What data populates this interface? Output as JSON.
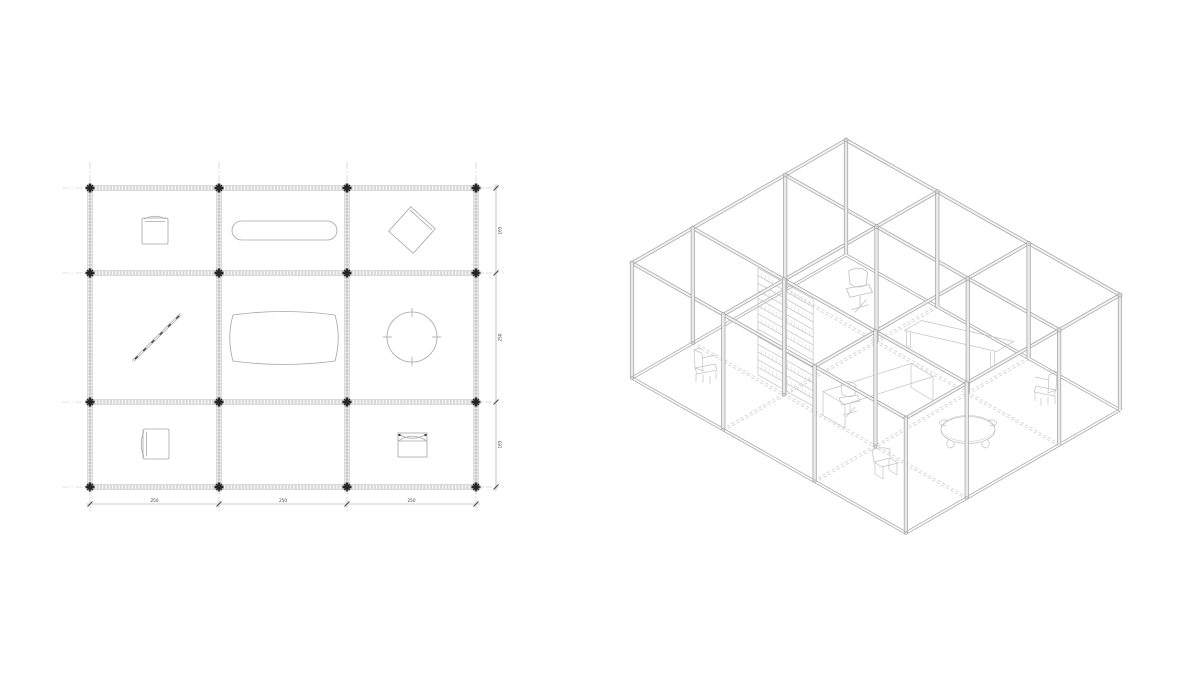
{
  "sheet": {
    "width": 1200,
    "height": 675,
    "background": "#ffffff"
  },
  "plan": {
    "title": "floor-plan",
    "grid_x": [
      90,
      219,
      347,
      476
    ],
    "grid_y": [
      188,
      273,
      402,
      487
    ],
    "centerline_extension": 26,
    "styles": {
      "wall_fill": "#d8d8d8",
      "wall_edge": "#b3b3b3",
      "centerline": "#c4c4c4",
      "column_marker": "#262626",
      "furniture_line": "#a6a6a6",
      "dim_line": "#9a9a9a",
      "tick": "#4a4a4a",
      "text": "#3f3f3f"
    },
    "dimensions_bottom": {
      "y": 504,
      "labels": [
        "250",
        "250",
        "250"
      ]
    },
    "dimensions_right": {
      "x": 496,
      "labels": [
        "165",
        "250",
        "165"
      ]
    },
    "furniture": [
      {
        "type": "chair",
        "name": "armchair-top-left",
        "x": 142,
        "y": 218,
        "w": 26,
        "h": 26,
        "back": "top"
      },
      {
        "type": "stadium",
        "name": "shelf-top-middle",
        "x": 232,
        "y": 221,
        "w": 105,
        "h": 19
      },
      {
        "type": "diamond",
        "name": "armchair-rotated-top-right",
        "cx": 412,
        "cy": 230,
        "s": 33,
        "rot": 42
      },
      {
        "type": "ladder",
        "name": "ladder-middle-left",
        "x1": 133,
        "y1": 361,
        "x2": 181,
        "y2": 314,
        "rungs": 6
      },
      {
        "type": "barrel",
        "name": "table-center",
        "cx": 284,
        "cy": 338,
        "w": 108,
        "h": 50
      },
      {
        "type": "round",
        "name": "round-table-middle-right",
        "cx": 412,
        "cy": 337,
        "r": 25
      },
      {
        "type": "chair",
        "name": "armchair-bottom-left",
        "x": 143,
        "y": 429,
        "w": 26,
        "h": 30,
        "back": "left"
      },
      {
        "type": "cabinet",
        "name": "stool-bottom-right",
        "x": 398,
        "y": 433,
        "w": 29,
        "h": 24
      }
    ]
  },
  "iso": {
    "title": "isometric-view",
    "origin": [
      846,
      140
    ],
    "ux": [
      0.7078,
      0.4005
    ],
    "uy": [
      -0.7157,
      0.4114
    ],
    "wall_height": 115,
    "xticks": [
      0,
      129,
      258,
      387
    ],
    "yticks": [
      0,
      85,
      214,
      299
    ],
    "styles": {
      "frame_edge": "#a9a9a9",
      "beam_core": "#f3f3f3",
      "column_core": "#eaeaea",
      "hidden_dash": "#c7c7c7",
      "node": "#d6d6d6",
      "node_edge": "#9d9d9d",
      "furniture_line": "#c2c2c2"
    },
    "furniture": [
      {
        "type": "bookshelf",
        "name": "bookshelf",
        "px1": 92,
        "px2": 170,
        "py": 214,
        "ztop": 3,
        "zbot": 110,
        "shelves": 14
      },
      {
        "type": "deskchair",
        "name": "office-chair",
        "cx": 860,
        "cy": 296,
        "s": 1.25,
        "flip": 1
      },
      {
        "type": "bench",
        "name": "long-table",
        "cx": 959,
        "cy": 336
      },
      {
        "type": "desk",
        "name": "meeting-table",
        "cx": 878,
        "cy": 384
      },
      {
        "type": "deskchair",
        "name": "desk-chair",
        "cx": 850,
        "cy": 404,
        "s": 1.0,
        "flip": 1
      },
      {
        "type": "armchair",
        "name": "armchair-left",
        "cx": 707,
        "cy": 372,
        "flip": 1
      },
      {
        "type": "armchair",
        "name": "armchair-right",
        "cx": 1044,
        "cy": 394,
        "flip": -1
      },
      {
        "type": "roundtable",
        "name": "round-table",
        "cx": 968,
        "cy": 430
      },
      {
        "type": "stool",
        "name": "small-chair-front",
        "cx": 888,
        "cy": 472
      }
    ]
  }
}
